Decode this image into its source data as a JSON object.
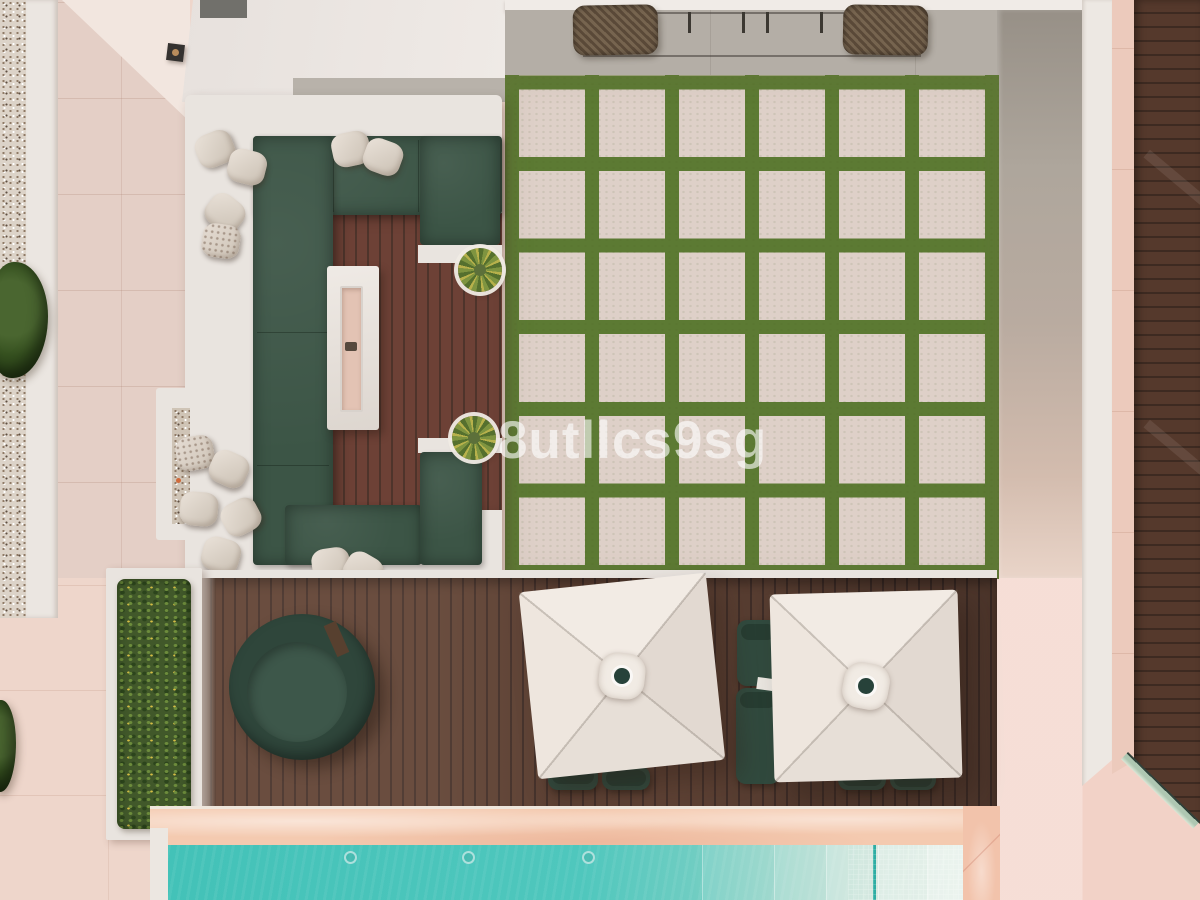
{
  "scene": {
    "description": "Aerial top-down drone photo of a modern villa terrace: white C-shaped lounge sofa with dark green cushions around a marble fire-pit table on hardwood decking, a checkerboard patio of pale pavers separated by strips of grass, a lower wooden deck with a round daybed, green sun loungers and two square white parasols, bordered by a hedge planter, gravel strips and a turquoise swimming pool",
    "watermark": "8utllcs9sg",
    "colors": {
      "pool": "#4cc5bb",
      "grass": "#5c7a33",
      "paver": "#e0d1c9",
      "deck": "#5f4334",
      "cushion": "#3c5546",
      "frame-white": "#e9e4df",
      "walkway-pink": "#e4cfc6",
      "coping": "#f4cab0",
      "concrete": "#b4aea6",
      "umbrella": "#eae3dc"
    },
    "objects": [
      "gravel-strip",
      "garden-bushes",
      "pink-tile-walkway",
      "building-ceiling",
      "ceiling-spotlight",
      "concrete-patio",
      "outdoor-dining-chairs",
      "lounge-sofa",
      "throw-pillows",
      "fire-pit-table",
      "potted-plants",
      "grass-grid-patio",
      "lower-wood-deck",
      "hedge-planter",
      "round-daybed",
      "sun-loungers",
      "square-parasols",
      "pool-coping",
      "swimming-pool",
      "pool-steps",
      "glass-balustrade",
      "side-deck"
    ]
  }
}
